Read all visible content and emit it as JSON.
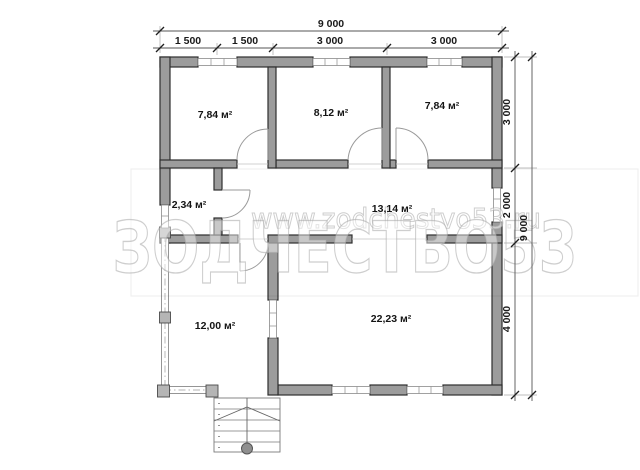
{
  "plan": {
    "rooms": [
      {
        "id": "bedroom-1",
        "area": "7,84 м²"
      },
      {
        "id": "bedroom-2",
        "area": "8,12 м²"
      },
      {
        "id": "bedroom-3",
        "area": "7,84 м²"
      },
      {
        "id": "vestibule",
        "area": "2,34 м²"
      },
      {
        "id": "corridor",
        "area": "13,14 м²"
      },
      {
        "id": "veranda",
        "area": "12,00 м²"
      },
      {
        "id": "living-room",
        "area": "22,23 м²"
      }
    ],
    "dimensions": {
      "top_total": "9 000",
      "top_segments": [
        "1 500",
        "1 500",
        "3 000",
        "3 000"
      ],
      "right_total": "9 000",
      "right_segments": [
        "3 000",
        "2 000",
        "4 000"
      ]
    },
    "watermark": {
      "url": "www.zodchestvo53.ru",
      "brand": "ЗОДЧЕСТВО53"
    },
    "colors": {
      "wall_fill": "#9c9c9c",
      "wall_outline": "#2e2e2e",
      "text": "#1a1a1a",
      "watermark": "#ababab"
    }
  }
}
